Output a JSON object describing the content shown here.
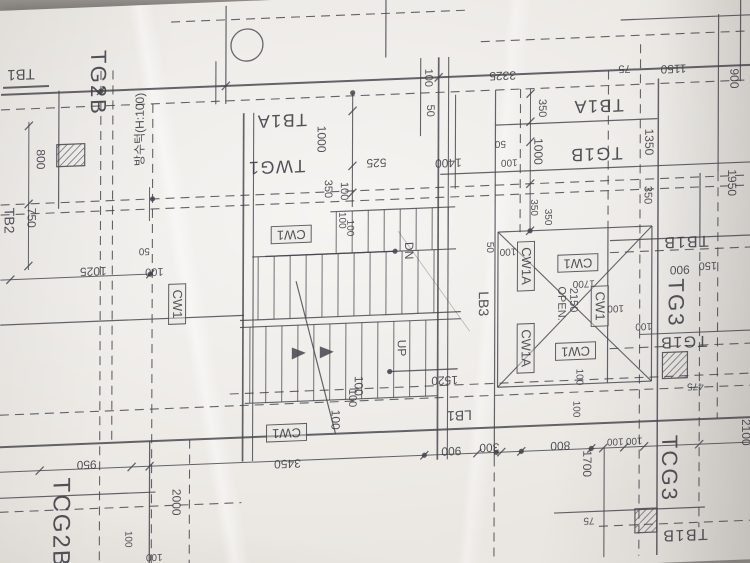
{
  "drawing": {
    "ink_color": "#44444c",
    "paper_color": "#eae7e2",
    "labels": [
      {
        "text": "TB1",
        "x": 20,
        "y": 60,
        "r": 180,
        "s": 15
      },
      {
        "text": "TG2B",
        "x": 97,
        "y": 72,
        "r": 90,
        "s": 22
      },
      {
        "text": "방수턱(H:100)",
        "x": 139,
        "y": 120,
        "r": -90,
        "s": 12
      },
      {
        "text": "800",
        "x": 40,
        "y": 146,
        "r": 90,
        "s": 12
      },
      {
        "text": "750",
        "x": 31,
        "y": 204,
        "r": 90,
        "s": 12
      },
      {
        "text": "TB2",
        "x": 9,
        "y": 206,
        "r": 90,
        "s": 14
      },
      {
        "text": "1025",
        "x": 93,
        "y": 260,
        "r": 180,
        "s": 12
      },
      {
        "text": "100",
        "x": 154,
        "y": 262,
        "r": 180,
        "s": 11
      },
      {
        "text": "50",
        "x": 144,
        "y": 241,
        "r": 180,
        "s": 10
      },
      {
        "text": "CW1",
        "x": 177,
        "y": 296,
        "r": 90,
        "s": 13,
        "b": true
      },
      {
        "text": "TB1A",
        "x": 281,
        "y": 117,
        "r": 180,
        "s": 18
      },
      {
        "text": "TWG1",
        "x": 276,
        "y": 163,
        "r": 180,
        "s": 18
      },
      {
        "text": "1000",
        "x": 321,
        "y": 137,
        "r": 90,
        "s": 12
      },
      {
        "text": "350",
        "x": 327,
        "y": 187,
        "r": 90,
        "s": 11
      },
      {
        "text": "100",
        "x": 343,
        "y": 190,
        "r": 90,
        "s": 11
      },
      {
        "text": "525",
        "x": 376,
        "y": 163,
        "r": 180,
        "s": 12
      },
      {
        "text": "1400",
        "x": 448,
        "y": 166,
        "r": 180,
        "s": 12
      },
      {
        "text": "100",
        "x": 427,
        "y": 80,
        "r": 90,
        "s": 11
      },
      {
        "text": "50",
        "x": 429,
        "y": 113,
        "r": 90,
        "s": 11
      },
      {
        "text": "3325",
        "x": 502,
        "y": 81,
        "r": 180,
        "s": 12
      },
      {
        "text": "75",
        "x": 624,
        "y": 78,
        "r": 180,
        "s": 11
      },
      {
        "text": "1150",
        "x": 673,
        "y": 81,
        "r": 180,
        "s": 12
      },
      {
        "text": "900",
        "x": 734,
        "y": 93,
        "r": 90,
        "s": 12
      },
      {
        "text": "350",
        "x": 541,
        "y": 115,
        "r": 90,
        "s": 11
      },
      {
        "text": "TB1A",
        "x": 598,
        "y": 115,
        "r": 180,
        "s": 18
      },
      {
        "text": "TG1B",
        "x": 596,
        "y": 163,
        "r": 180,
        "s": 18
      },
      {
        "text": "1000",
        "x": 538,
        "y": 158,
        "r": 90,
        "s": 12
      },
      {
        "text": "100",
        "x": 509,
        "y": 167,
        "r": 180,
        "s": 10
      },
      {
        "text": "50",
        "x": 500,
        "y": 148,
        "r": 180,
        "s": 10
      },
      {
        "text": "1350",
        "x": 649,
        "y": 153,
        "r": 90,
        "s": 12
      },
      {
        "text": "1950",
        "x": 732,
        "y": 197,
        "r": 90,
        "s": 12
      },
      {
        "text": "350",
        "x": 647,
        "y": 206,
        "r": 90,
        "s": 11
      },
      {
        "text": "350",
        "x": 533,
        "y": 214,
        "r": 90,
        "s": 10
      },
      {
        "text": "350",
        "x": 547,
        "y": 224,
        "r": 90,
        "s": 10
      },
      {
        "text": "CW1",
        "x": 291,
        "y": 231,
        "r": 180,
        "s": 13,
        "b": true
      },
      {
        "text": "100",
        "x": 341,
        "y": 219,
        "r": 90,
        "s": 10
      },
      {
        "text": "100",
        "x": 349,
        "y": 227,
        "r": 90,
        "s": 10
      },
      {
        "text": "DN",
        "x": 409,
        "y": 252,
        "r": 90,
        "s": 12
      },
      {
        "text": "50",
        "x": 489,
        "y": 252,
        "r": 90,
        "s": 10
      },
      {
        "text": "100",
        "x": 508,
        "y": 256,
        "r": 180,
        "s": 10
      },
      {
        "text": "LB3",
        "x": 484,
        "y": 308,
        "r": 90,
        "s": 14
      },
      {
        "text": "CW1A",
        "x": 526,
        "y": 272,
        "r": 90,
        "s": 13,
        "b": true
      },
      {
        "text": "CW1A",
        "x": 526,
        "y": 354,
        "r": 90,
        "s": 13,
        "b": true
      },
      {
        "text": "CW1",
        "x": 578,
        "y": 271,
        "r": 180,
        "s": 13,
        "b": true
      },
      {
        "text": "CW1",
        "x": 576,
        "y": 359,
        "r": 180,
        "s": 13,
        "b": true
      },
      {
        "text": "OPEN.",
        "x": 561,
        "y": 311,
        "r": 90,
        "s": 11
      },
      {
        "text": "2150",
        "x": 573,
        "y": 308,
        "r": 90,
        "s": 11
      },
      {
        "text": "1700",
        "x": 584,
        "y": 291,
        "r": 180,
        "s": 10
      },
      {
        "text": "CW1",
        "x": 600,
        "y": 315,
        "r": 90,
        "s": 13,
        "b": true
      },
      {
        "text": "100",
        "x": 616,
        "y": 317,
        "r": 180,
        "s": 10
      },
      {
        "text": "100",
        "x": 644,
        "y": 336,
        "r": 180,
        "s": 10
      },
      {
        "text": "TB1B",
        "x": 686,
        "y": 253,
        "r": 180,
        "s": 16
      },
      {
        "text": "900",
        "x": 680,
        "y": 282,
        "r": 180,
        "s": 12
      },
      {
        "text": "150",
        "x": 708,
        "y": 278,
        "r": 180,
        "s": 11
      },
      {
        "text": "TG3",
        "x": 676,
        "y": 315,
        "r": 90,
        "s": 22
      },
      {
        "text": "TG1B",
        "x": 684,
        "y": 353,
        "r": 180,
        "s": 16
      },
      {
        "text": "UP",
        "x": 402,
        "y": 349,
        "r": 90,
        "s": 12
      },
      {
        "text": "100",
        "x": 359,
        "y": 385,
        "r": 90,
        "s": 12
      },
      {
        "text": "100",
        "x": 352,
        "y": 397,
        "r": 90,
        "s": 11
      },
      {
        "text": "100",
        "x": 336,
        "y": 418,
        "r": 90,
        "s": 12
      },
      {
        "text": "1520",
        "x": 445,
        "y": 383,
        "r": 180,
        "s": 12
      },
      {
        "text": "LB1",
        "x": 460,
        "y": 419,
        "r": 180,
        "s": 14
      },
      {
        "text": "900",
        "x": 452,
        "y": 454,
        "r": 180,
        "s": 12
      },
      {
        "text": "300",
        "x": 490,
        "y": 452,
        "r": 180,
        "s": 12
      },
      {
        "text": "800",
        "x": 561,
        "y": 453,
        "r": 180,
        "s": 12
      },
      {
        "text": "1700",
        "x": 588,
        "y": 472,
        "r": 90,
        "s": 12
      },
      {
        "text": "3450",
        "x": 288,
        "y": 460,
        "r": 180,
        "s": 12
      },
      {
        "text": "CW1",
        "x": 287,
        "y": 429,
        "r": 180,
        "s": 13,
        "b": true
      },
      {
        "text": "950",
        "x": 87,
        "y": 453,
        "r": 180,
        "s": 12
      },
      {
        "text": "TCG2B",
        "x": 61,
        "y": 510,
        "r": 90,
        "s": 24
      },
      {
        "text": "2000",
        "x": 177,
        "y": 494,
        "r": 90,
        "s": 12
      },
      {
        "text": "100",
        "x": 128,
        "y": 529,
        "r": 90,
        "s": 10
      },
      {
        "text": "100",
        "x": 155,
        "y": 547,
        "r": 180,
        "s": 10
      },
      {
        "text": "475",
        "x": 696,
        "y": 398,
        "r": 180,
        "s": 10
      },
      {
        "text": "100",
        "x": 576,
        "y": 417,
        "r": 90,
        "s": 10
      },
      {
        "text": "100",
        "x": 579,
        "y": 385,
        "r": 90,
        "s": 10
      },
      {
        "text": "100",
        "x": 616,
        "y": 450,
        "r": 180,
        "s": 10
      },
      {
        "text": "100",
        "x": 635,
        "y": 450,
        "r": 180,
        "s": 10
      },
      {
        "text": "TCG3",
        "x": 670,
        "y": 480,
        "r": 90,
        "s": 22
      },
      {
        "text": "75",
        "x": 590,
        "y": 528,
        "r": 180,
        "s": 10
      },
      {
        "text": "TB1B",
        "x": 686,
        "y": 546,
        "r": 180,
        "s": 16
      },
      {
        "text": "2100",
        "x": 747,
        "y": 447,
        "r": 90,
        "s": 12
      }
    ]
  }
}
